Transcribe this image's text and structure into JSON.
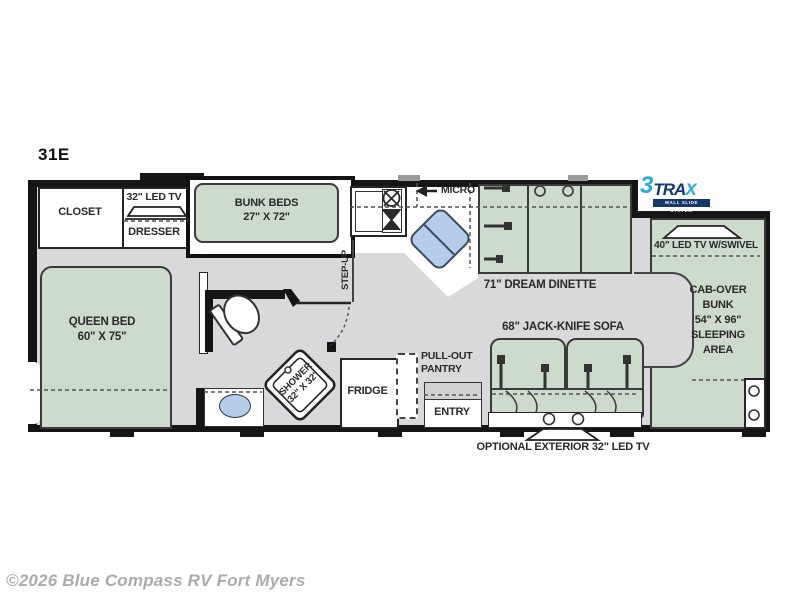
{
  "plan": {
    "id": "31E"
  },
  "watermark": "©2026 Blue Compass RV Fort Myers",
  "logo": {
    "prefix": "3",
    "mid": "TRA",
    "suffix": "X",
    "tagline": "WALL SLIDE SYSTEM"
  },
  "rooms": {
    "closet": "CLOSET",
    "tv32": "32\" LED TV",
    "dresser": "DRESSER",
    "bunk": {
      "l1": "BUNK BEDS",
      "l2": "27\" X 72\""
    },
    "micro": "MICRO",
    "dinette": "71\" DREAM DINETTE",
    "tv40": "40\" LED TV W/SWIVEL",
    "cabover": {
      "l1": "CAB-OVER",
      "l2": "BUNK",
      "l3": "54\" X 96\"",
      "l4": "SLEEPING",
      "l5": "AREA"
    },
    "queen": {
      "l1": "QUEEN BED",
      "l2": "60\" X 75\""
    },
    "stepup": "STEP-UP",
    "shower": {
      "l1": "SHOWER",
      "l2": "32\" X 32\""
    },
    "fridge": "FRIDGE",
    "pantry": {
      "l1": "PULL-OUT",
      "l2": "PANTRY"
    },
    "entry": "ENTRY",
    "sofa": "68\" JACK-KNIFE SOFA",
    "ext_tv": "OPTIONAL EXTERIOR 32\" LED TV"
  },
  "colors": {
    "furniture": "#ccdbcc",
    "floor": "#d9d9db",
    "accent_blue": "#b5cde9",
    "wall": "#151515",
    "logo_cyan": "#29a9e1",
    "logo_navy": "#14386b",
    "watermark": "#ababab"
  }
}
